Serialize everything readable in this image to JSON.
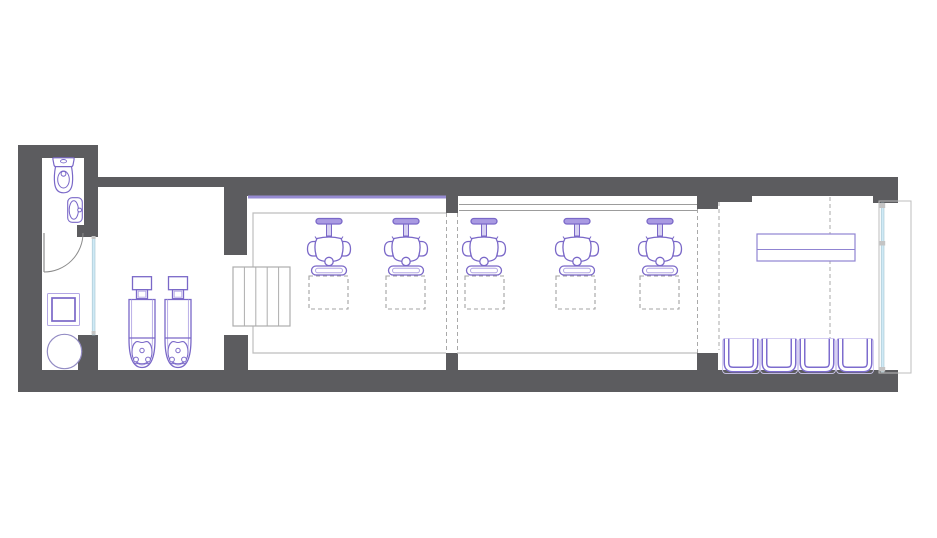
{
  "title": "salon-floor-plan",
  "canvas": {
    "width": 937,
    "height": 538
  },
  "colors": {
    "wall": "#5c5c5f",
    "bg": "#ffffff",
    "furn": "#7a68c8",
    "furnLight": "#b3a7e4",
    "furnDesk": "#9084d2",
    "furnMuted": "#938cc4",
    "mirror": "#968bd2",
    "glass": "#cfeaf6",
    "glassEdge": "#a5c3cf",
    "mullion": "#c4c4c4",
    "outline": "#bdbdbd",
    "counter": "#9c9c9c",
    "stairs": "#adadad",
    "zone": "#a9a9a9",
    "mat": "#a3a3a3",
    "door": "#8c8c8c"
  },
  "counts": {
    "styling_chairs": 5,
    "wash_units": 2,
    "waiting_chairs": 4,
    "station_mats": 5
  },
  "plan": {
    "elements": [
      {
        "kind": "rect",
        "name": "bathroom-top-wall",
        "x": 18,
        "y": 145,
        "w": 80,
        "h": 13,
        "fill": "wall"
      },
      {
        "kind": "rect",
        "name": "left-outer-wall",
        "x": 18,
        "y": 145,
        "w": 24,
        "h": 247,
        "fill": "wall"
      },
      {
        "kind": "rect",
        "name": "bottom-outer-wall",
        "x": 18,
        "y": 370,
        "w": 880,
        "h": 22,
        "fill": "wall"
      },
      {
        "kind": "rect",
        "name": "top-outer-wall",
        "x": 84,
        "y": 177,
        "w": 814,
        "h": 19,
        "fill": "wall"
      },
      {
        "kind": "rect",
        "name": "washroom-wall-recess",
        "x": 98,
        "y": 187,
        "w": 126,
        "h": 9,
        "fill": "bg"
      },
      {
        "kind": "rect",
        "name": "bathroom-right-wall",
        "x": 84,
        "y": 158,
        "w": 14,
        "h": 67,
        "fill": "wall"
      },
      {
        "kind": "rect",
        "name": "bathroom-door-stub",
        "x": 77,
        "y": 225,
        "w": 21,
        "h": 12,
        "fill": "wall"
      },
      {
        "kind": "rect",
        "name": "bathroom-lower-stub",
        "x": 78,
        "y": 335,
        "w": 20,
        "h": 35,
        "fill": "wall"
      },
      {
        "kind": "rect",
        "name": "washarea-divider-wall",
        "x": 224,
        "y": 196,
        "w": 23,
        "h": 59,
        "fill": "wall"
      },
      {
        "kind": "rect",
        "name": "washarea-divider-stub",
        "x": 224,
        "y": 335,
        "w": 24,
        "h": 35,
        "fill": "wall"
      },
      {
        "kind": "rect",
        "name": "divider1-top-tab",
        "x": 446,
        "y": 196,
        "w": 12,
        "h": 17,
        "fill": "wall"
      },
      {
        "kind": "rect",
        "name": "divider1-bottom-stub",
        "x": 446,
        "y": 353,
        "w": 12,
        "h": 17,
        "fill": "wall"
      },
      {
        "kind": "rect",
        "name": "divider2-top-tab",
        "x": 697,
        "y": 196,
        "w": 21,
        "h": 13,
        "fill": "wall"
      },
      {
        "kind": "rect",
        "name": "divider2-bottom-stub",
        "x": 697,
        "y": 353,
        "w": 21,
        "h": 17,
        "fill": "wall"
      },
      {
        "kind": "rect",
        "name": "reception-top-lip",
        "x": 718,
        "y": 196,
        "w": 34,
        "h": 6,
        "fill": "wall"
      },
      {
        "kind": "rect",
        "name": "reception-corner-block",
        "x": 873,
        "y": 196,
        "w": 25,
        "h": 7,
        "fill": "wall"
      },
      {
        "kind": "rect",
        "name": "mirror-ledge",
        "x": 248,
        "y": 195.5,
        "w": 198,
        "h": 3,
        "fill": "mirror"
      },
      {
        "kind": "path",
        "name": "section1-floor-outline",
        "d": "M446,213 L253,213 L253,353 L446,353",
        "stroke": "outline",
        "sw": 1.2
      },
      {
        "kind": "line",
        "name": "section2-counter-line-a",
        "x1": 459,
        "y1": 204.5,
        "x2": 697,
        "y2": 204.5,
        "stroke": "counter",
        "sw": 1
      },
      {
        "kind": "line",
        "name": "section2-counter-line-b",
        "x1": 459,
        "y1": 210.5,
        "x2": 697,
        "y2": 210.5,
        "stroke": "counter",
        "sw": 1
      },
      {
        "kind": "line",
        "name": "section2-floor-line",
        "x1": 457,
        "y1": 353,
        "x2": 697,
        "y2": 353,
        "stroke": "outline",
        "sw": 1.2
      },
      {
        "kind": "rect",
        "name": "steps-box",
        "x": 233,
        "y": 267,
        "w": 57,
        "h": 59,
        "fill": "bg",
        "stroke": "stairs",
        "sw": 1.2
      },
      {
        "kind": "line",
        "name": "steps-tread-1",
        "x1": 244.4,
        "y1": 267,
        "x2": 244.4,
        "y2": 326,
        "stroke": "stairs",
        "sw": 1
      },
      {
        "kind": "line",
        "name": "steps-tread-2",
        "x1": 255.8,
        "y1": 267,
        "x2": 255.8,
        "y2": 326,
        "stroke": "stairs",
        "sw": 1
      },
      {
        "kind": "line",
        "name": "steps-tread-3",
        "x1": 267.2,
        "y1": 267,
        "x2": 267.2,
        "y2": 326,
        "stroke": "stairs",
        "sw": 1
      },
      {
        "kind": "line",
        "name": "steps-tread-4",
        "x1": 278.6,
        "y1": 267,
        "x2": 278.6,
        "y2": 326,
        "stroke": "stairs",
        "sw": 1
      },
      {
        "kind": "line",
        "name": "door-leaf",
        "x1": 44,
        "y1": 233,
        "x2": 44,
        "y2": 272,
        "stroke": "door",
        "sw": 1.2
      },
      {
        "kind": "path",
        "name": "door-swing-arc",
        "d": "M44,272 A39,39 0 0 0 83,233",
        "stroke": "door",
        "sw": 1
      },
      {
        "kind": "rect",
        "name": "glass-partition",
        "x": 92.2,
        "y": 237,
        "w": 2.8,
        "h": 98,
        "fill": "glass",
        "stroke": "glassEdge",
        "sw": 0.6
      },
      {
        "kind": "rect",
        "name": "glass-partition-cap-top",
        "x": 91.6,
        "y": 236,
        "w": 4,
        "h": 3,
        "fill": "mullion"
      },
      {
        "kind": "rect",
        "name": "glass-partition-cap-bottom",
        "x": 91.6,
        "y": 331,
        "w": 4,
        "h": 3.5,
        "fill": "mullion"
      },
      {
        "kind": "rect",
        "name": "storefront-outline",
        "x": 879,
        "y": 201,
        "w": 32,
        "h": 172,
        "stroke": "outline",
        "sw": 1
      },
      {
        "kind": "rect",
        "name": "storefront-glass",
        "x": 881.2,
        "y": 203,
        "w": 2.8,
        "h": 169,
        "fill": "glass",
        "stroke": "glassEdge",
        "sw": 0.6
      },
      {
        "kind": "rect",
        "name": "storefront-mullion-top",
        "x": 879.6,
        "y": 203,
        "w": 5.6,
        "h": 5,
        "fill": "mullion"
      },
      {
        "kind": "rect",
        "name": "storefront-mullion-mid",
        "x": 879.6,
        "y": 241,
        "w": 5.6,
        "h": 4.5,
        "fill": "mullion"
      },
      {
        "kind": "rect",
        "name": "storefront-mullion-bottom",
        "x": 879.6,
        "y": 367,
        "w": 5.6,
        "h": 4.5,
        "fill": "mullion"
      },
      {
        "kind": "line",
        "name": "zone-dash-divider1-left",
        "x1": 446.5,
        "y1": 213,
        "x2": 446.5,
        "y2": 353,
        "stroke": "zone",
        "sw": 1,
        "dash": "4 3"
      },
      {
        "kind": "line",
        "name": "zone-dash-divider1-right",
        "x1": 457.5,
        "y1": 213,
        "x2": 457.5,
        "y2": 353,
        "stroke": "zone",
        "sw": 1,
        "dash": "4 3"
      },
      {
        "kind": "line",
        "name": "zone-dash-divider2",
        "x1": 697.5,
        "y1": 209,
        "x2": 697.5,
        "y2": 353,
        "stroke": "zone",
        "sw": 1,
        "dash": "4 3"
      },
      {
        "kind": "line",
        "name": "zone-dash-reception-left",
        "x1": 719,
        "y1": 202,
        "x2": 719,
        "y2": 350,
        "stroke": "zone",
        "sw": 1,
        "dash": "4 3"
      },
      {
        "kind": "line",
        "name": "zone-dash-reception-mid",
        "x1": 830,
        "y1": 197,
        "x2": 830,
        "y2": 350,
        "stroke": "zone",
        "sw": 1,
        "dash": "4 3"
      },
      {
        "kind": "rect",
        "name": "station-mat-1",
        "x": 309,
        "y": 276,
        "w": 39,
        "h": 33,
        "stroke": "mat",
        "sw": 1.1,
        "dash": "4 3"
      },
      {
        "kind": "rect",
        "name": "station-mat-2",
        "x": 386,
        "y": 276,
        "w": 39,
        "h": 33,
        "stroke": "mat",
        "sw": 1.1,
        "dash": "4 3"
      },
      {
        "kind": "rect",
        "name": "station-mat-3",
        "x": 465,
        "y": 276,
        "w": 39,
        "h": 33,
        "stroke": "mat",
        "sw": 1.1,
        "dash": "4 3"
      },
      {
        "kind": "rect",
        "name": "station-mat-4",
        "x": 556,
        "y": 276,
        "w": 39,
        "h": 33,
        "stroke": "mat",
        "sw": 1.1,
        "dash": "4 3"
      },
      {
        "kind": "rect",
        "name": "station-mat-5",
        "x": 640,
        "y": 276,
        "w": 39,
        "h": 33,
        "stroke": "mat",
        "sw": 1.1,
        "dash": "4 3"
      },
      {
        "kind": "use",
        "name": "toilet",
        "href": "sym-toilet",
        "x": 51,
        "y": 157,
        "w": 25,
        "h": 37
      },
      {
        "kind": "use",
        "name": "sink",
        "href": "sym-sink",
        "x": 67,
        "y": 197,
        "w": 16,
        "h": 26
      },
      {
        "kind": "rect",
        "name": "washing-machine",
        "x": 47.5,
        "y": 293.5,
        "w": 32,
        "h": 32,
        "rx": 1,
        "fill": "bg",
        "stroke": "furnLight",
        "sw": 1
      },
      {
        "kind": "rect",
        "name": "washing-machine-inner",
        "x": 52,
        "y": 298,
        "w": 23,
        "h": 23,
        "stroke": "furn",
        "sw": 1.7
      },
      {
        "kind": "circle",
        "name": "utility-stool",
        "cx": 64.5,
        "cy": 351.5,
        "r": 17.2,
        "fill": "bg",
        "stroke": "furnMuted",
        "sw": 1.2
      },
      {
        "kind": "use",
        "name": "shampoo-wash-unit-1",
        "href": "sym-wash-unit",
        "x": 127,
        "y": 276,
        "w": 30,
        "h": 94
      },
      {
        "kind": "use",
        "name": "shampoo-wash-unit-2",
        "href": "sym-wash-unit",
        "x": 163,
        "y": 276,
        "w": 30,
        "h": 94
      },
      {
        "kind": "use",
        "name": "styling-chair-1",
        "href": "sym-styling-chair",
        "x": 305,
        "y": 216,
        "w": 48,
        "h": 62
      },
      {
        "kind": "use",
        "name": "styling-chair-2",
        "href": "sym-styling-chair",
        "x": 382,
        "y": 216,
        "w": 48,
        "h": 62
      },
      {
        "kind": "use",
        "name": "styling-chair-3",
        "href": "sym-styling-chair",
        "x": 460,
        "y": 216,
        "w": 48,
        "h": 62
      },
      {
        "kind": "use",
        "name": "styling-chair-4",
        "href": "sym-styling-chair",
        "x": 553,
        "y": 216,
        "w": 48,
        "h": 62
      },
      {
        "kind": "use",
        "name": "styling-chair-5",
        "href": "sym-styling-chair",
        "x": 636,
        "y": 216,
        "w": 48,
        "h": 62
      },
      {
        "kind": "rect",
        "name": "reception-desk",
        "x": 757,
        "y": 234,
        "w": 98,
        "h": 27,
        "fill": "bg",
        "stroke": "furnDesk",
        "sw": 1.2
      },
      {
        "kind": "line",
        "name": "reception-desk-divider",
        "x1": 757,
        "y1": 249.5,
        "x2": 855,
        "y2": 249.5,
        "stroke": "furnDesk",
        "sw": 1
      },
      {
        "kind": "use",
        "name": "waiting-chair-1",
        "href": "sym-waiting-chair",
        "x": 722,
        "y": 338,
        "w": 38,
        "h": 36
      },
      {
        "kind": "use",
        "name": "waiting-chair-2",
        "href": "sym-waiting-chair",
        "x": 760,
        "y": 338,
        "w": 38,
        "h": 36
      },
      {
        "kind": "use",
        "name": "waiting-chair-3",
        "href": "sym-waiting-chair",
        "x": 798,
        "y": 338,
        "w": 38,
        "h": 36
      },
      {
        "kind": "use",
        "name": "waiting-chair-4",
        "href": "sym-waiting-chair",
        "x": 836,
        "y": 338,
        "w": 38,
        "h": 36
      }
    ]
  }
}
